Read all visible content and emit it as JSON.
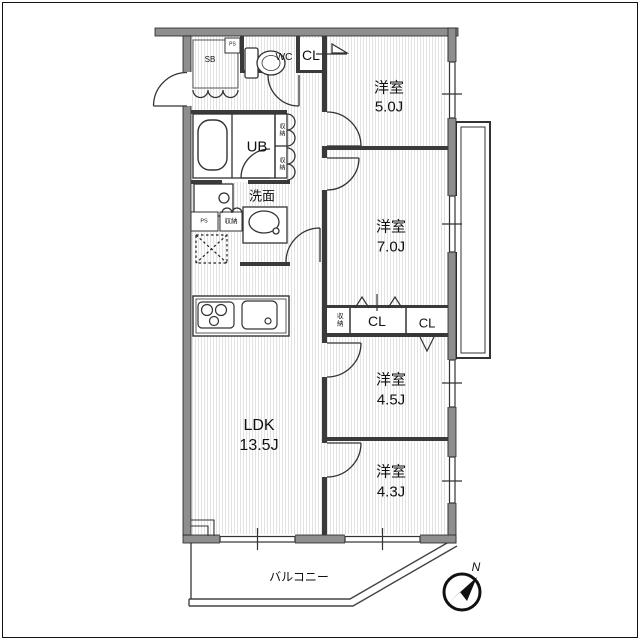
{
  "plan": {
    "rooms": {
      "bedroom1": {
        "name": "洋室",
        "size": "5.0J"
      },
      "bedroom2": {
        "name": "洋室",
        "size": "7.0J"
      },
      "bedroom3": {
        "name": "洋室",
        "size": "4.5J"
      },
      "bedroom4": {
        "name": "洋室",
        "size": "4.3J"
      },
      "ldk": {
        "name": "LDK",
        "size": "13.5J"
      },
      "balcony": {
        "name": "バルコニー"
      }
    },
    "fixtures": {
      "wc": "WC",
      "unit_bath": "UB",
      "washroom": "洗面",
      "shoe_box": "SB",
      "pipe_space": "PS",
      "storage": "収納",
      "closet": "CL"
    },
    "compass": {
      "north": "N"
    },
    "colors": {
      "wall": "#8e8e8e",
      "line": "#2a2a2a",
      "hatch": "#e2e2e2",
      "background": "#ffffff"
    }
  }
}
